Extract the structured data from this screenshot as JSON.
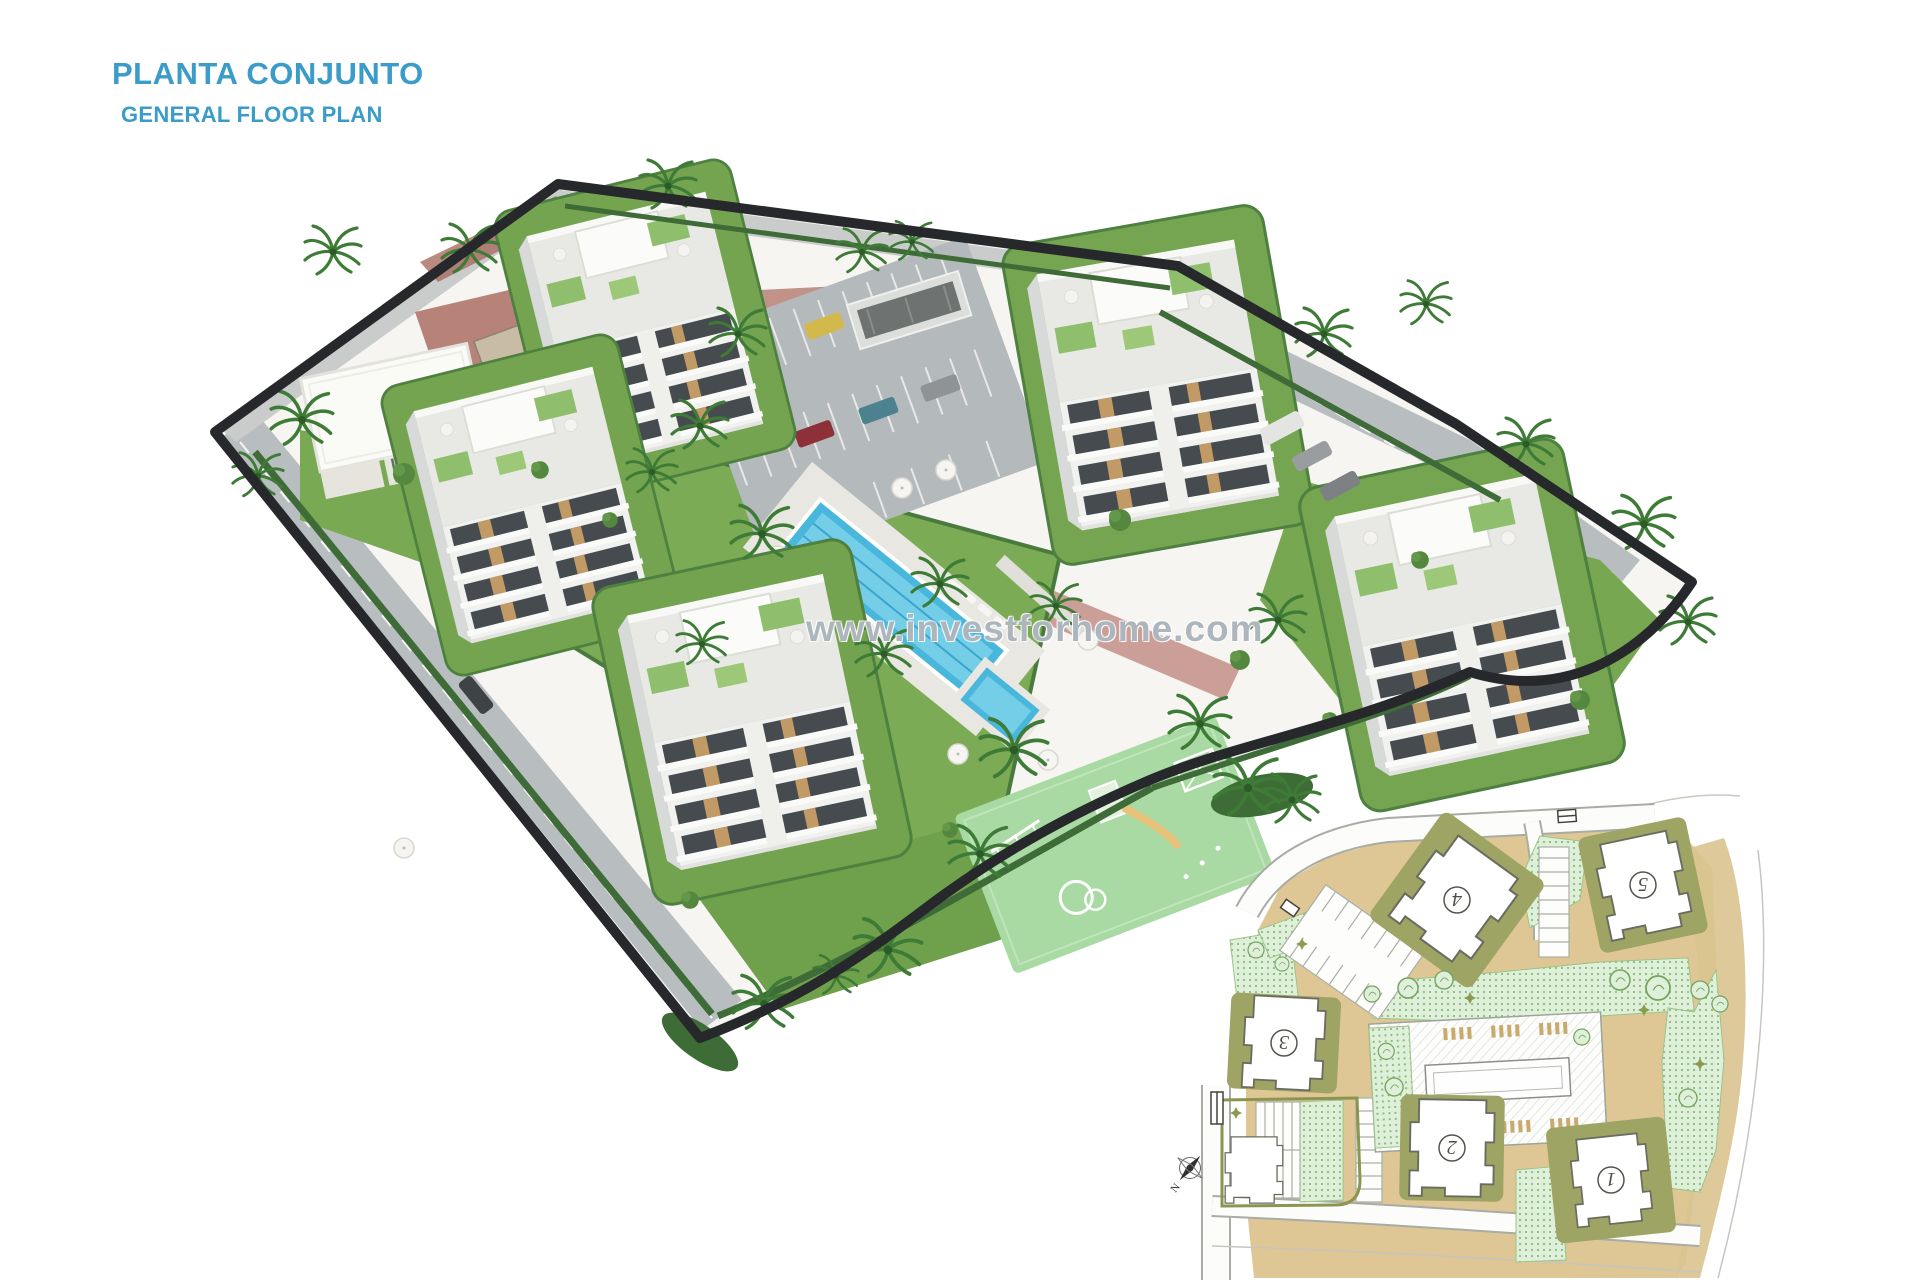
{
  "header": {
    "title": "PLANTA CONJUNTO",
    "subtitle": "GENERAL FLOOR PLAN",
    "accent_color": "#3B9CC9"
  },
  "watermark": {
    "text": "www.investforhome.com"
  },
  "render": {
    "colors": {
      "grass": "#7BAA55",
      "hedge": "#3E6B37",
      "pool_water": "#49B7DC",
      "playground": "#A9DAA3",
      "asphalt": "#B7BCBF",
      "boundary": "#26282B",
      "brick_path": "#AC6F63",
      "building": "#F1F2F0",
      "glazing": "#454B4F"
    }
  },
  "site_plan_inset": {
    "buildings": [
      {
        "label": "1"
      },
      {
        "label": "2"
      },
      {
        "label": "3"
      },
      {
        "label": "4"
      },
      {
        "label": "5"
      }
    ],
    "compass": {
      "label": "N"
    },
    "colors": {
      "path_tan": "#DEC795",
      "plot_olive": "#9EA464",
      "greenery": "#DFF0DA",
      "building_fill": "#FFFFFF"
    }
  }
}
